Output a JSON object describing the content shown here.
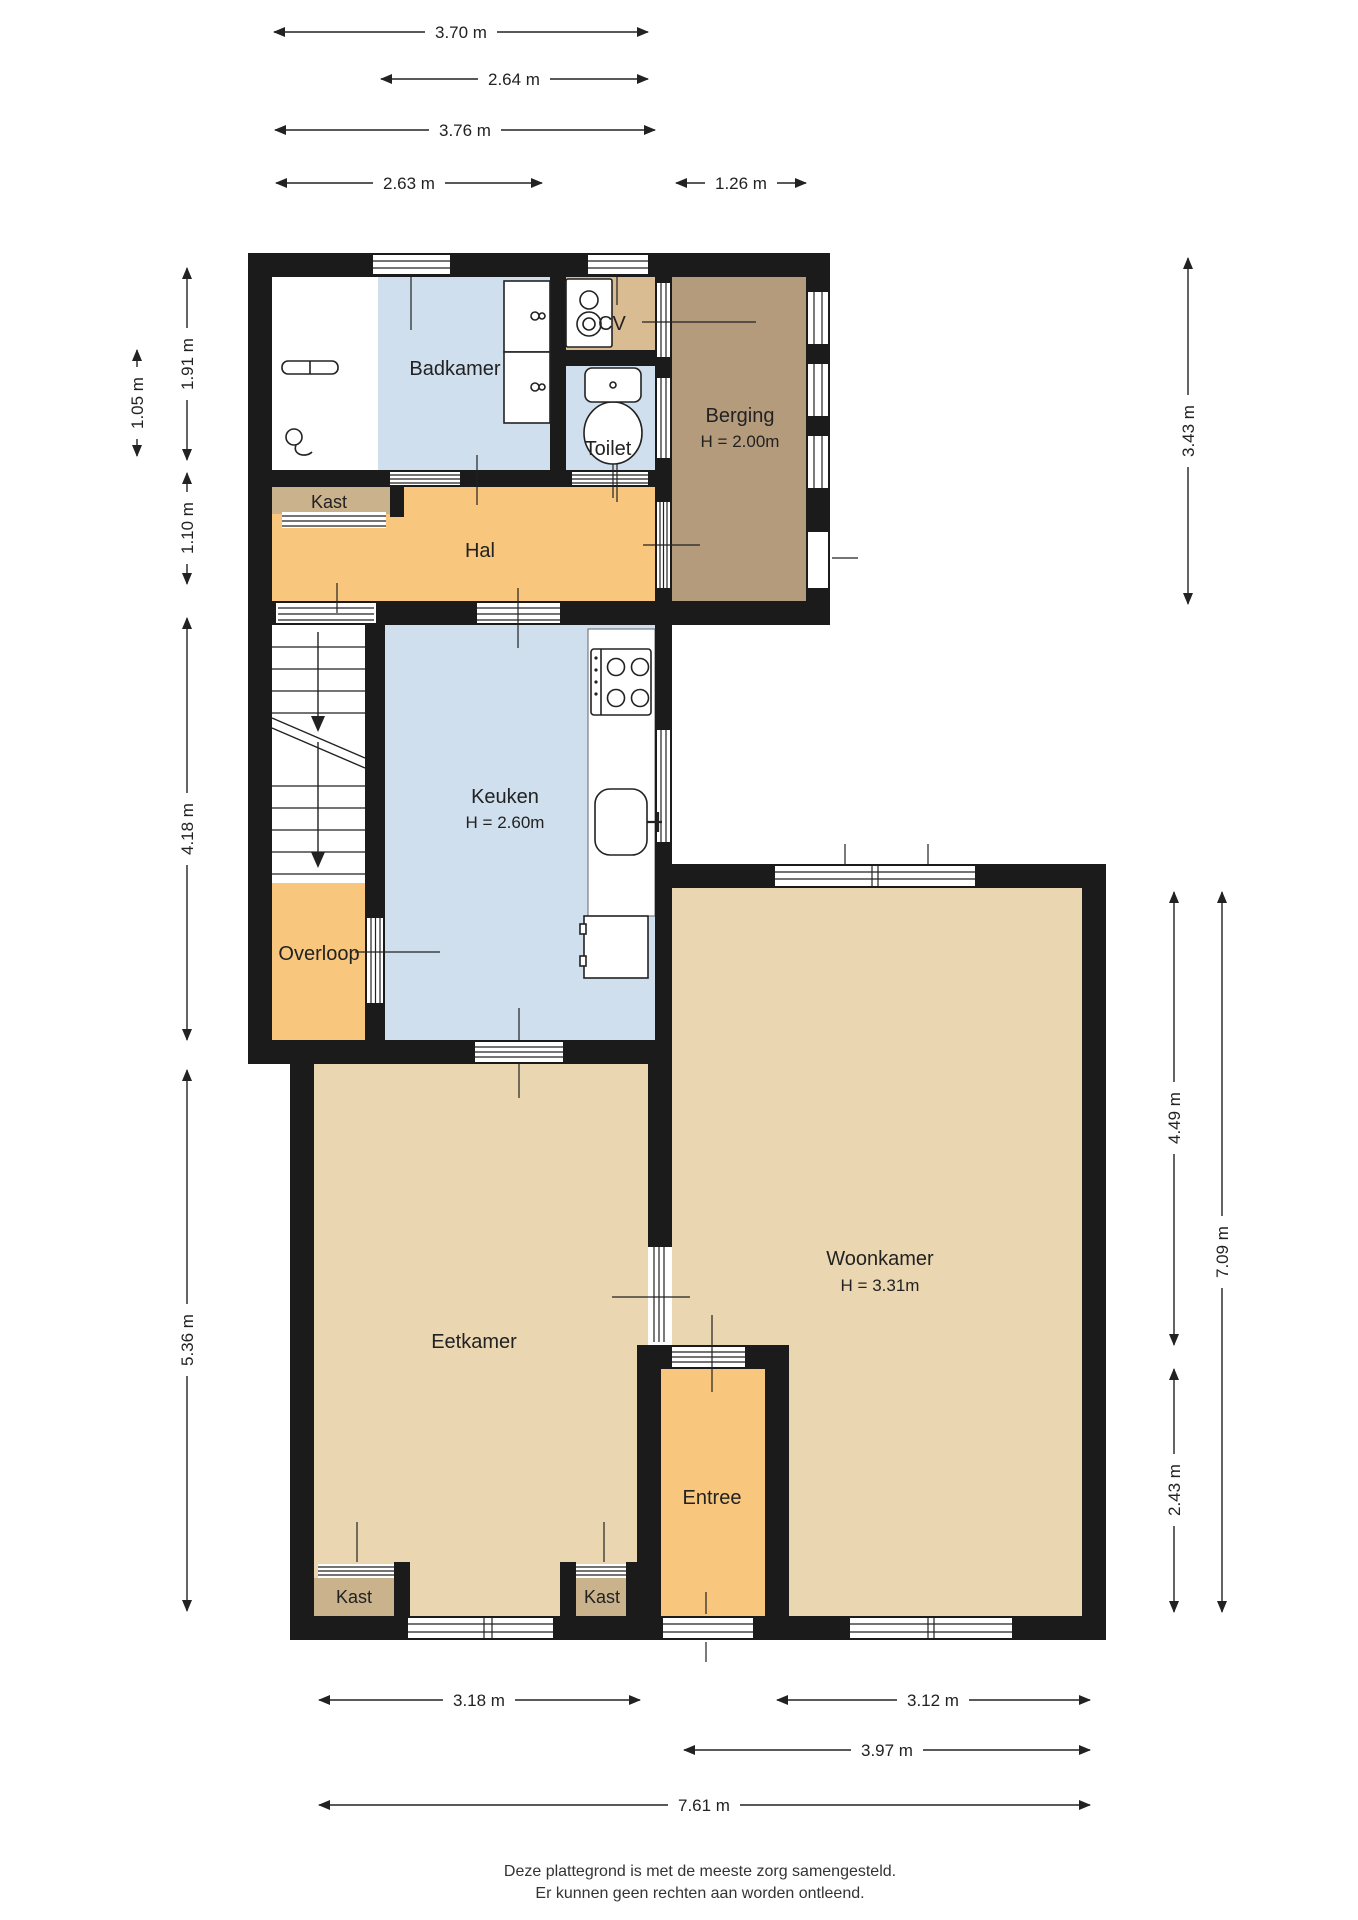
{
  "plan": {
    "type": "floorplan",
    "rooms": {
      "badkamer": {
        "label": "Badkamer"
      },
      "cv": {
        "label": "CV"
      },
      "toilet": {
        "label": "Toilet"
      },
      "berging": {
        "label": "Berging",
        "height": "H = 2.00m"
      },
      "kast_hal": {
        "label": "Kast"
      },
      "hal": {
        "label": "Hal"
      },
      "keuken": {
        "label": "Keuken",
        "height": "H = 2.60m"
      },
      "overloop": {
        "label": "Overloop"
      },
      "eetkamer": {
        "label": "Eetkamer"
      },
      "woonkamer": {
        "label": "Woonkamer",
        "height": "H = 3.31m"
      },
      "entree": {
        "label": "Entree"
      },
      "kast_eetkamer_links": {
        "label": "Kast"
      },
      "kast_eetkamer_rechts": {
        "label": "Kast"
      }
    },
    "dims": {
      "top": [
        "3.70 m",
        "2.64 m",
        "3.76 m",
        "2.63 m",
        "1.26 m"
      ],
      "left": [
        "1.05 m",
        "1.91 m",
        "1.10 m",
        "4.18 m",
        "5.36 m"
      ],
      "right": [
        "3.43 m",
        "4.49 m",
        "7.09 m",
        "2.43 m"
      ],
      "bottom": [
        "3.18 m",
        "3.12 m",
        "3.97 m",
        "7.61 m"
      ]
    },
    "footer": {
      "line1": "Deze plattegrond is met de meeste zorg samengesteld.",
      "line2": "Er kunnen geen rechten aan worden ontleend."
    },
    "colors": {
      "wall": "#1b1b1b",
      "line": "#222222",
      "floor_blue": "#cfdfee",
      "floor_orange": "#f8c67c",
      "floor_beige": "#ead6b0",
      "floor_tan": "#d9bc92",
      "floor_kast": "#c9b28c",
      "floor_brown": "#b49b7c",
      "white": "#ffffff"
    }
  }
}
